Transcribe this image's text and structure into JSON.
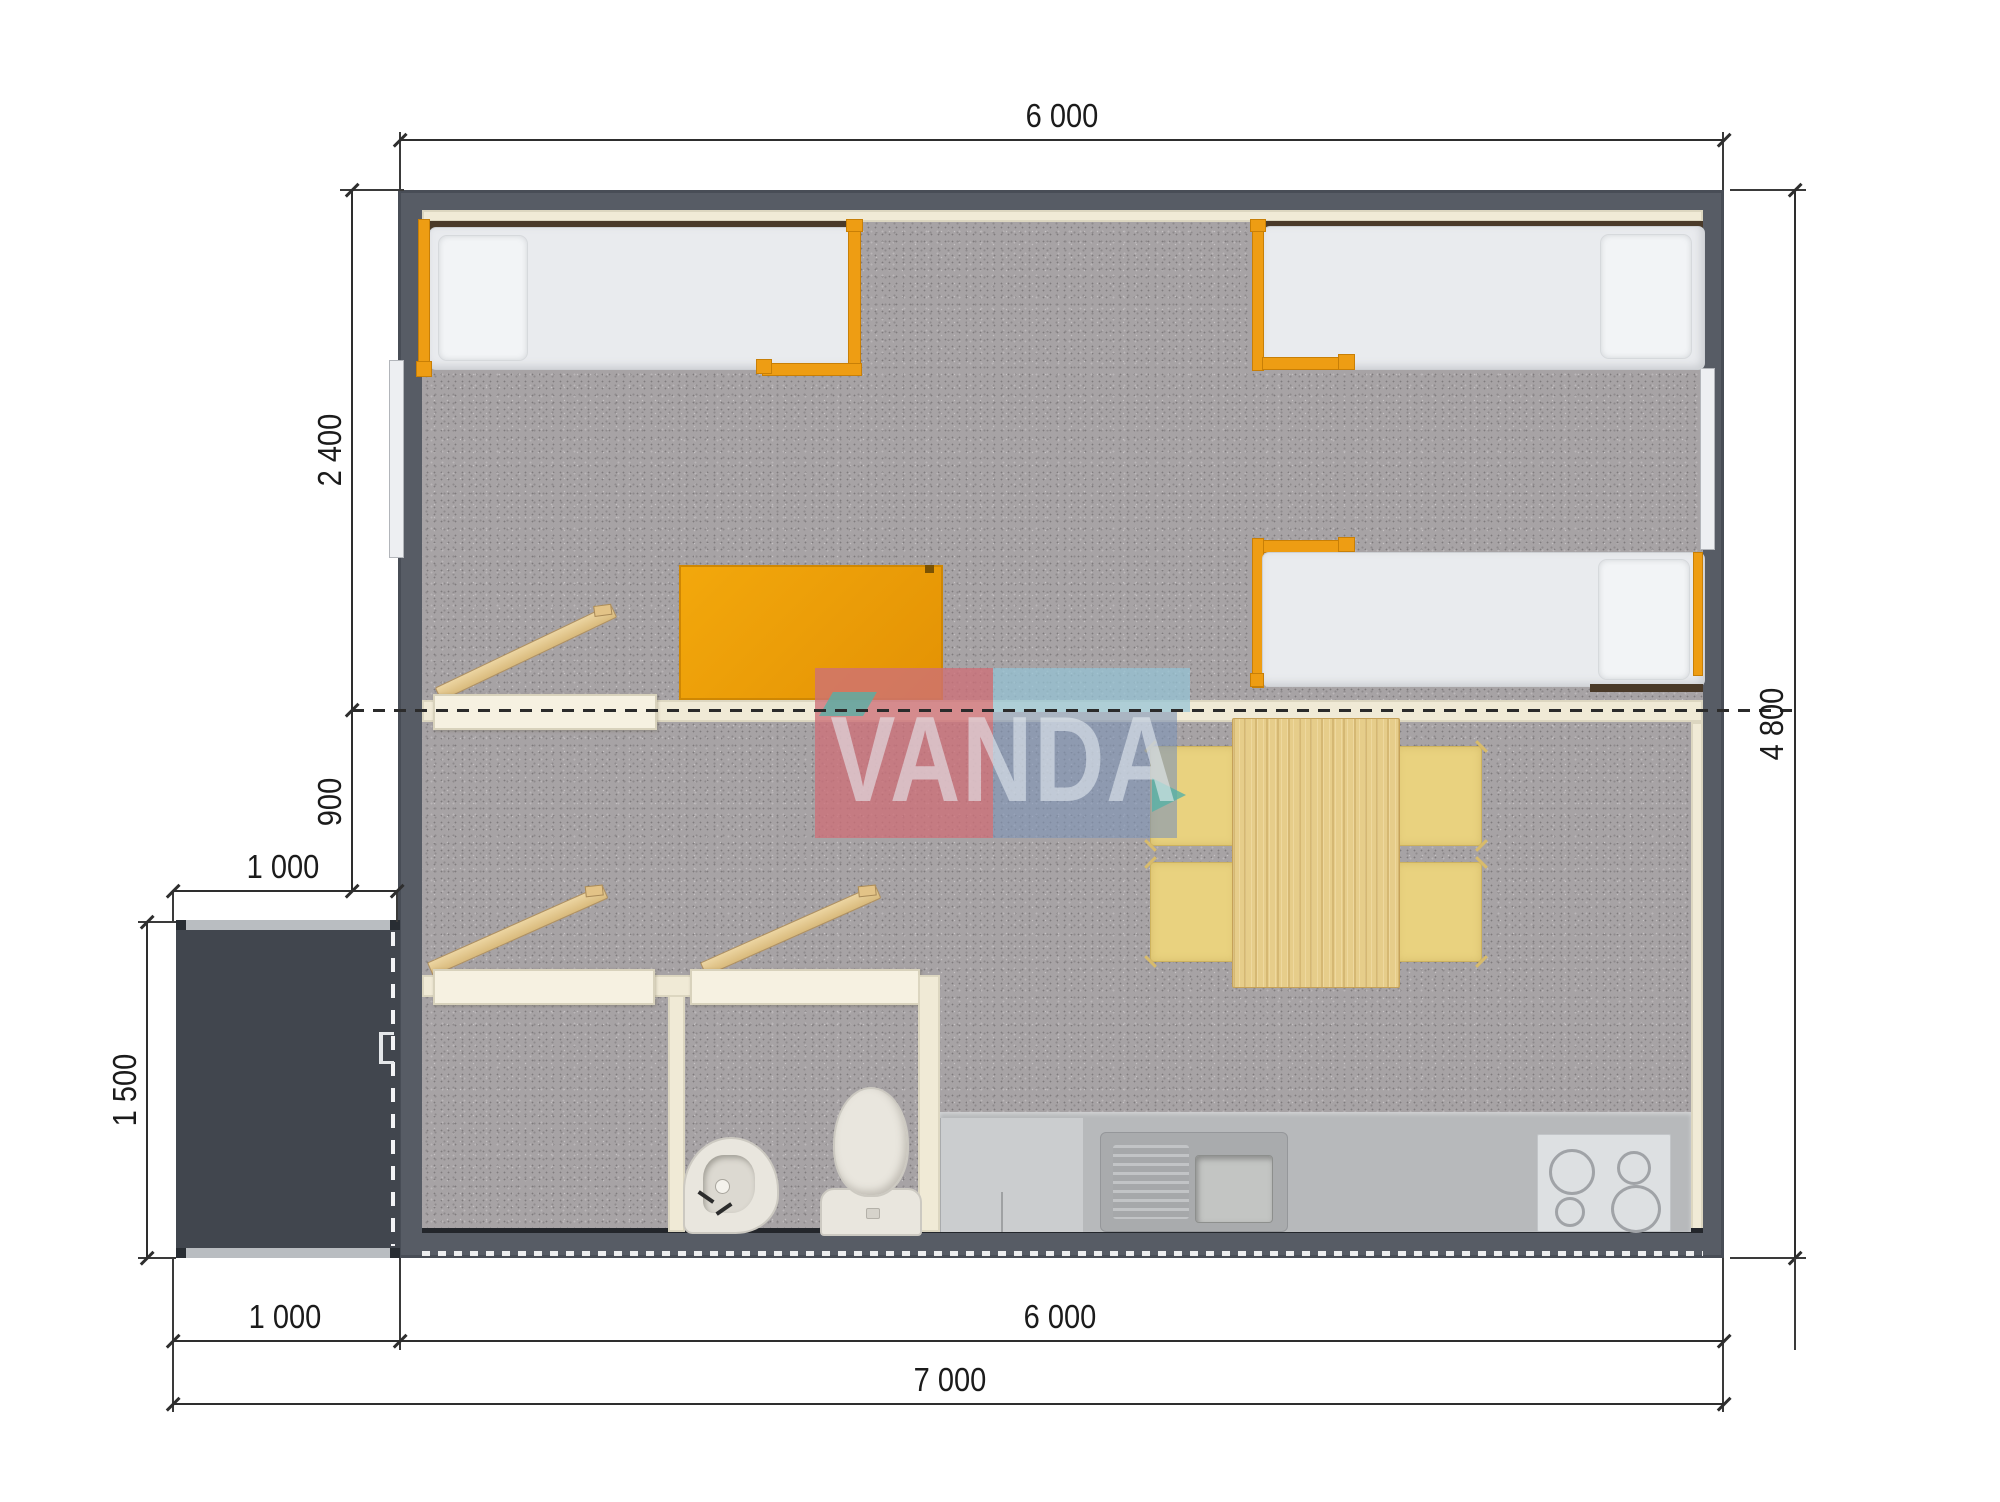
{
  "watermark": {
    "text": "VANDA"
  },
  "dimensions": {
    "top_width": "6 000",
    "right_height": "4 800",
    "bedroom_depth": "2 400",
    "hall_depth": "900",
    "porch_width": "1 000",
    "porch_depth": "1 500",
    "bottom_porch_width": "1 000",
    "bottom_building_width": "6 000",
    "bottom_total_width": "7 000"
  },
  "colors": {
    "wall": "#575c65",
    "porch": "#41464e",
    "floor_carpet": "#a7a3a5",
    "partition_cream": "#f0ead6",
    "accent_orange": "#ee9d13",
    "desk_orange": "#f0a30c",
    "wood": "#e6cd8a",
    "watermark_pink": "#cd7078",
    "watermark_blue": "#8094b6",
    "watermark_lightblue": "#94c4d6",
    "dimension_line": "#2e2e2e"
  }
}
